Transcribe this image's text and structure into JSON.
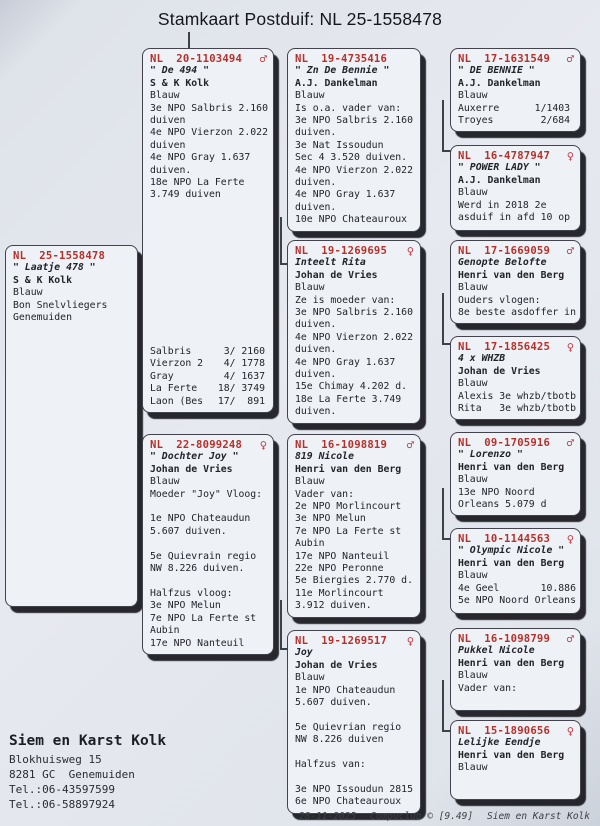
{
  "title": "Stamkaart Postduif: NL  25-1558478",
  "colors": {
    "accent_red": "#b5322c",
    "paper": "#e3e7ee",
    "box_background": "#eef1f6",
    "box_shadow": "#101218",
    "connector_line": "#3c414c"
  },
  "boxes": {
    "subject": {
      "ring": "NL  25-1558478",
      "sex": "",
      "name": "\" Laatje 478 \"",
      "loft": "S & K Kolk",
      "lines": [
        "Blauw",
        "Bon Snelvliegers",
        "Genemuiden"
      ]
    },
    "father": {
      "ring": "NL  20-1103494",
      "sex": "♂",
      "name": "\" De 494 \"",
      "loft": "S & K Kolk",
      "lines": [
        "Blauw",
        "3e NPO Salbris 2.160",
        "duiven",
        "4e NPO Vierzon 2.022",
        "duiven",
        "4e NPO Gray 1.637",
        "duiven.",
        "18e NPO La Ferte",
        "3.749 duiven"
      ],
      "stats": [
        [
          "Salbris",
          "3/ 2160"
        ],
        [
          "Vierzon 2",
          "4/ 1778"
        ],
        [
          "Gray",
          "4/ 1637"
        ],
        [
          "La Ferte",
          "18/ 3749"
        ],
        [
          "Laon (Bes",
          "17/  891"
        ]
      ]
    },
    "mother": {
      "ring": "NL  22-8099248",
      "sex": "♀",
      "name": "\" Dochter Joy \"",
      "loft": "Johan de Vries",
      "lines": [
        "Blauw",
        "Moeder \"Joy\" Vloog:",
        "",
        "1e NPO Chateaudun",
        "5.607 duiven.",
        "",
        "5e Quievrain regio",
        "NW 8.226 duiven.",
        "",
        "Halfzus vloog:",
        "3e NPO Melun",
        "7e NPO La Ferte st",
        "Aubin",
        "17e NPO Nanteuil"
      ]
    },
    "g1": {
      "ring": "NL  19-4735416",
      "sex": "",
      "name": "\" Zn De Bennie \"",
      "loft": "A.J. Dankelman",
      "lines": [
        "Blauw",
        "Is o.a. vader van:",
        "3e NPO Salbris 2.160",
        "duiven.",
        "3e Nat Issoudun",
        "Sec 4 3.520 duiven.",
        "4e NPO Vierzon 2.022",
        "duiven.",
        "4e NPO Gray 1.637",
        "duiven.",
        "10e NPO Chateauroux"
      ]
    },
    "g2": {
      "ring": "NL  19-1269695",
      "sex": "♀",
      "name": "Inteelt Rita",
      "loft": "Johan de Vries",
      "lines": [
        "Blauw",
        "Ze is moeder van:",
        "3e NPO Salbris 2.160",
        "duiven.",
        "4e NPO Vierzon 2.022",
        "duiven.",
        "4e NPO Gray 1.637",
        "duiven.",
        "15e Chimay 4.202 d.",
        "18e La Ferte 3.749",
        "duiven."
      ]
    },
    "g3": {
      "ring": "NL  16-1098819",
      "sex": "♂",
      "name": "819 Nicole",
      "loft": "Henri van den Berg",
      "lines": [
        "Blauw",
        "Vader van:",
        "2e NPO Morlincourt",
        "3e NPO Melun",
        "7e NPO La Ferte st",
        "Aubin",
        "17e NPO Nanteuil",
        "22e NPO Peronne",
        "5e Biergies 2.770 d.",
        "11e Morlincourt",
        "3.912 duiven."
      ]
    },
    "g4": {
      "ring": "NL  19-1269517",
      "sex": "♀",
      "name": "Joy",
      "loft": "Johan de Vries",
      "lines": [
        "Blauw",
        "1e NPO Chateaudun",
        "5.607 duiven.",
        "",
        "5e Quievrian regio",
        "NW 8.226 duiven",
        "",
        "Halfzus van:",
        "",
        "3e NPO Issoudun 2815",
        "6e NPO Chateauroux"
      ]
    },
    "gg1": {
      "ring": "NL  17-1631549",
      "sex": "♂",
      "name": "\" DE BENNIE \"",
      "loft": "A.J. Dankelman",
      "lines": [
        "Blauw",
        "Auxerre      1/1403",
        "Troyes        2/684"
      ]
    },
    "gg2": {
      "ring": "NL  16-4787947",
      "sex": "♀",
      "name": "\" POWER LADY \"",
      "loft": "A.J. Dankelman",
      "lines": [
        "Blauw",
        "Werd in 2018 2e",
        "asduif in afd 10 op"
      ]
    },
    "gg3": {
      "ring": "NL  17-1669059",
      "sex": "♂",
      "name": "Genopte Belofte",
      "loft": "Henri van den Berg",
      "lines": [
        "Blauw",
        "Ouders vlogen:",
        "8e beste asdoffer in"
      ]
    },
    "gg4": {
      "ring": "NL  17-1856425",
      "sex": "♀",
      "name": "4 x WHZB",
      "loft": "Johan de Vries",
      "lines": [
        "Blauw",
        "Alexis 3e whzb/tbotb",
        "Rita   3e whzb/tbotb"
      ]
    },
    "gg5": {
      "ring": "NL  09-1705916",
      "sex": "♂",
      "name": "\" Lorenzo \"",
      "loft": "Henri van den Berg",
      "lines": [
        "Blauw",
        "13e NPO Noord",
        "Orleans 5.079 d"
      ]
    },
    "gg6": {
      "ring": "NL  10-1144563",
      "sex": "♀",
      "name": "\" Olympic Nicole \"",
      "loft": "Henri van den Berg",
      "lines": [
        "Blauw",
        "4e Geel       10.886",
        "5e NPO Noord Orleans"
      ]
    },
    "gg7": {
      "ring": "NL  16-1098799",
      "sex": "♂",
      "name": "Pukkel Nicole",
      "loft": "Henri van den Berg",
      "lines": [
        "Blauw",
        "Vader van:"
      ]
    },
    "gg8": {
      "ring": "NL  15-1890656",
      "sex": "♀",
      "name": "Lelijke Eendje",
      "loft": "Henri van den Berg",
      "lines": [
        "Blauw"
      ]
    }
  },
  "contact": {
    "name": "Siem en Karst Kolk",
    "lines": [
      "Blokhuisweg 15",
      "8281 GC  Genemuiden",
      "Tel.:06-43597599",
      "Tel.:06-58897924"
    ]
  },
  "footer": {
    "date": "28-11-2025",
    "app": "Compuclub © [9.49]",
    "owner": "Siem en Karst Kolk"
  }
}
